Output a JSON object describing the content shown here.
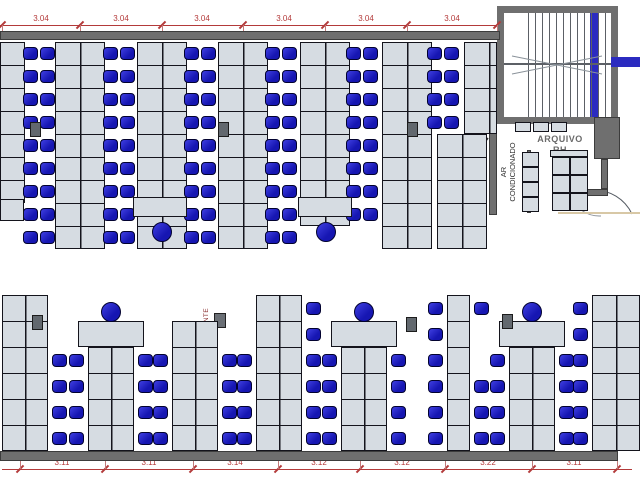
{
  "floor_plan": {
    "colors": {
      "chair_blue": "#1616b2",
      "desk_gray": "#d6dce2",
      "wall_gray": "#6f6f6f",
      "dimension_red": "#b33a3a",
      "stair_rail_blue": "#2b2bc0",
      "floor_edge_beige": "#d8c8a6",
      "hidrante_text": "#8a2f2f"
    },
    "labels": {
      "arquivo_line1": "ARQUIVO",
      "arquivo_line2": "RH",
      "ar_line1": "AR",
      "ar_line2": "CONDICIONADO",
      "hidrante": "HIDRANTE"
    },
    "top_dimension": {
      "y": 25,
      "x1": 0,
      "x2": 497,
      "tick_xs": [
        2,
        80,
        162,
        243,
        325,
        407,
        497
      ],
      "label_xs": [
        41,
        121,
        202,
        284,
        366,
        452
      ],
      "labels": [
        "3.04",
        "3.04",
        "3.04",
        "3.04",
        "3.04",
        "3.04"
      ]
    },
    "bottom_dimension": {
      "y": 469,
      "x1": 2,
      "x2": 632,
      "tick_xs": [
        20,
        105,
        193,
        278,
        360,
        445,
        532,
        617
      ],
      "label_xs": [
        62,
        149,
        235,
        319,
        402,
        488,
        574
      ],
      "labels": [
        "3.11",
        "3.11",
        "3.14",
        "3.12",
        "3.12",
        "3.22",
        "3.11"
      ]
    },
    "walls": [
      [
        0,
        31,
        500,
        9
      ],
      [
        0,
        451,
        618,
        10
      ],
      [
        489,
        131,
        8,
        84
      ],
      [
        527,
        150,
        4,
        63
      ],
      [
        594,
        117,
        26,
        42
      ],
      [
        601,
        159,
        7,
        30
      ],
      [
        584,
        189,
        24,
        7
      ]
    ],
    "top_band": {
      "row_h": 23,
      "desk_blocks": [
        [
          0,
          42,
          25,
          7
        ],
        [
          55,
          42,
          50,
          9
        ],
        [
          137,
          42,
          50,
          9
        ],
        [
          218,
          42,
          50,
          9
        ],
        [
          300,
          42,
          50,
          8
        ],
        [
          382,
          42,
          50,
          9
        ],
        [
          437,
          134,
          50,
          5
        ],
        [
          464,
          42,
          33,
          4
        ]
      ],
      "chair_pairs": [
        {
          "cx": 39,
          "rows": 9
        },
        {
          "cx": 119,
          "rows": 9
        },
        {
          "cx": 200,
          "rows": 9
        },
        {
          "cx": 281,
          "rows": 9
        },
        {
          "cx": 362,
          "rows": 8
        },
        {
          "cx": 443,
          "rows": 4
        }
      ],
      "h_desks": [
        [
          0,
          199,
          24,
          22
        ],
        [
          133,
          197,
          54,
          20
        ],
        [
          298,
          197,
          54,
          20
        ]
      ],
      "round_chairs": [
        [
          152,
          222
        ],
        [
          316,
          222
        ]
      ]
    },
    "bottom_band": {
      "row_h": 26,
      "floor_y": 451,
      "groups": [
        {
          "x": 2,
          "w": 46,
          "rows": 6,
          "top_desk": false,
          "round_chair": false,
          "chairs_left": [],
          "chairs_right": [
            0,
            1,
            2,
            3
          ]
        },
        {
          "x": 88,
          "w": 46,
          "rows": 4,
          "top_desk": true,
          "round_chair": true,
          "chairs_left": [
            0,
            1,
            2,
            3
          ],
          "chairs_right": [
            0,
            1,
            2,
            3
          ]
        },
        {
          "x": 172,
          "w": 46,
          "rows": 5,
          "top_desk": false,
          "round_chair": false,
          "chairs_left": [
            0,
            1,
            2,
            3
          ],
          "chairs_right": [
            0,
            1,
            2,
            3
          ]
        },
        {
          "x": 256,
          "w": 46,
          "rows": 6,
          "top_desk": false,
          "round_chair": false,
          "chairs_left": [
            0,
            1,
            2,
            3
          ],
          "chairs_right": [
            0,
            1,
            2,
            3,
            4,
            5
          ]
        },
        {
          "x": 341,
          "w": 46,
          "rows": 4,
          "top_desk": true,
          "round_chair": true,
          "chairs_left": [
            0,
            1,
            2,
            3
          ],
          "chairs_right": [
            0,
            1,
            2,
            3
          ]
        },
        {
          "x": 447,
          "w": 23,
          "rows": 6,
          "top_desk": false,
          "round_chair": false,
          "chairs_left": [
            0,
            1,
            2,
            3,
            4,
            5
          ],
          "chairs_right": [
            0,
            1,
            2,
            5
          ]
        },
        {
          "x": 509,
          "w": 46,
          "rows": 4,
          "top_desk": true,
          "round_chair": true,
          "chairs_left": [
            0,
            1,
            2,
            3
          ],
          "chairs_right": [
            0,
            1,
            2,
            3
          ]
        },
        {
          "x": 592,
          "w": 48,
          "rows": 6,
          "top_desk": false,
          "round_chair": false,
          "chairs_left": [
            0,
            1,
            2,
            3,
            4,
            5
          ],
          "chairs_right": []
        }
      ]
    },
    "printers": [
      [
        30,
        122
      ],
      [
        218,
        122
      ],
      [
        407,
        122
      ],
      [
        32,
        315
      ],
      [
        406,
        317
      ],
      [
        502,
        314
      ]
    ],
    "cabinets": [
      [
        515,
        122,
        16,
        10
      ],
      [
        533,
        122,
        16,
        10
      ],
      [
        551,
        122,
        16,
        10
      ],
      [
        522,
        152,
        17,
        15
      ],
      [
        522,
        167,
        17,
        15
      ],
      [
        522,
        182,
        17,
        15
      ],
      [
        522,
        197,
        17,
        15
      ],
      [
        550,
        150,
        38,
        7
      ],
      [
        552,
        157,
        18,
        18
      ],
      [
        570,
        157,
        18,
        18
      ],
      [
        552,
        175,
        18,
        18
      ],
      [
        570,
        175,
        18,
        18
      ],
      [
        552,
        193,
        18,
        18
      ],
      [
        570,
        193,
        18,
        18
      ]
    ],
    "beige_line": [
      558,
      212,
      82,
      2
    ]
  }
}
